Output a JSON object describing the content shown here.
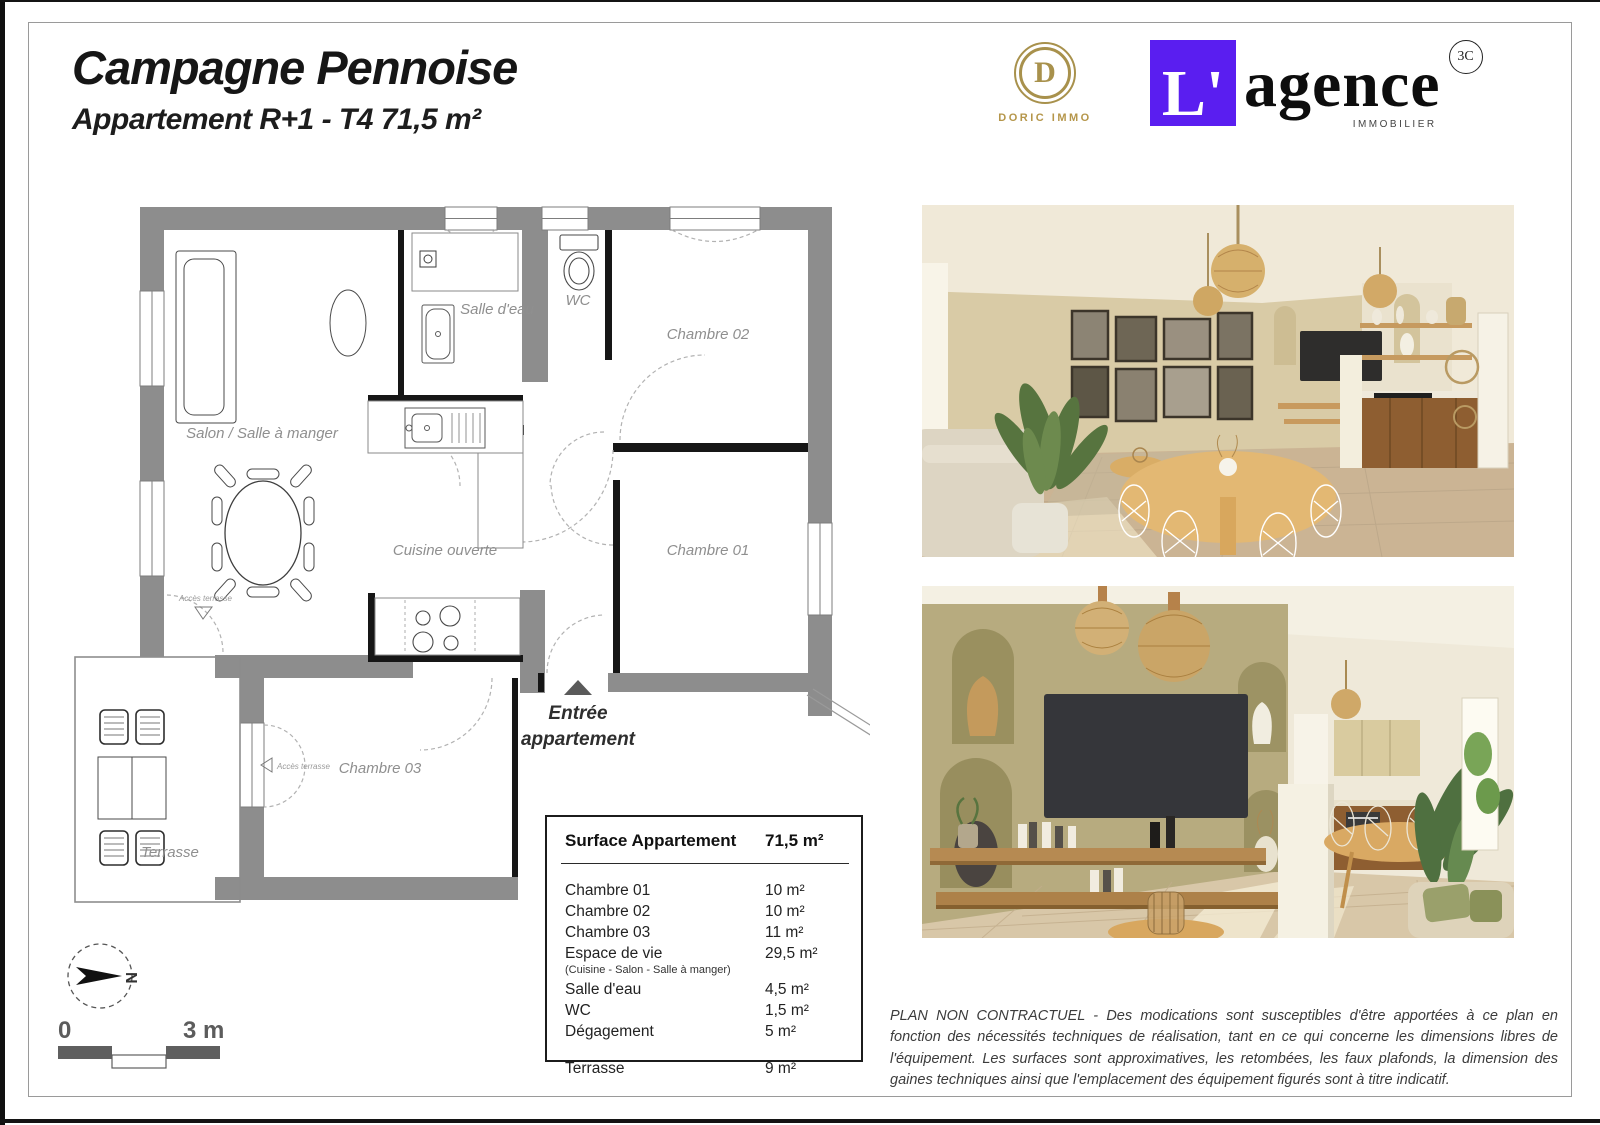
{
  "header": {
    "title": "Campagne Pennoise",
    "subtitle": "Appartement R+1 - T4  71,5 m²"
  },
  "logos": {
    "doric": {
      "initial": "D",
      "caption": "DORIC IMMO",
      "gold": "#a8914c"
    },
    "agence": {
      "prefix": "L'",
      "word": "agence",
      "badge": "3C",
      "caption": "IMMOBILIER",
      "purple": "#5a1ef0"
    }
  },
  "plan": {
    "labels": {
      "salon": "Salon / Salle à manger",
      "salle_eau": "Salle d'eau",
      "wc": "WC",
      "chambre02": "Chambre 02",
      "chambre01": "Chambre 01",
      "cuisine": "Cuisine ouverte",
      "chambre03": "Chambre 03",
      "terrasse": "Terrasse",
      "acces_terrasse_salon": "Accès terrasse",
      "acces_terrasse_ch03": "Accès terrasse",
      "entree_line1": "Entrée",
      "entree_line2": "appartement",
      "north": "N"
    },
    "scale": {
      "start": "0",
      "end": "3 m"
    },
    "wall_color": "#8d8d8d"
  },
  "surface_table": {
    "header": {
      "label": "Surface Appartement",
      "value": "71,5 m²"
    },
    "rows": [
      {
        "label": "Chambre 01",
        "value": "10 m²"
      },
      {
        "label": "Chambre 02",
        "value": "10 m²"
      },
      {
        "label": "Chambre 03",
        "value": "11 m²"
      },
      {
        "label": "Espace de vie",
        "value": "29,5 m²"
      },
      {
        "label": "(Cuisine - Salon - Salle à manger)",
        "value": ""
      },
      {
        "label": "Salle d'eau",
        "value": "4,5 m²"
      },
      {
        "label": "WC",
        "value": "1,5 m²"
      },
      {
        "label": "Dégagement",
        "value": "5 m²"
      },
      {
        "label": "Terrasse",
        "value": "9 m²"
      }
    ]
  },
  "disclaimer": {
    "text": "PLAN NON CONTRACTUEL - Des modications sont susceptibles d'être apportées à ce plan en fonction des nécessités techniques de réalisation, tant en ce qui concerne les dimensions libres de l'équipement. Les surfaces sont approximatives, les retombées, les faux plafonds, la dimension des gaines techniques ainsi que l'emplacement des équipement figurés sont à titre indicatif."
  }
}
